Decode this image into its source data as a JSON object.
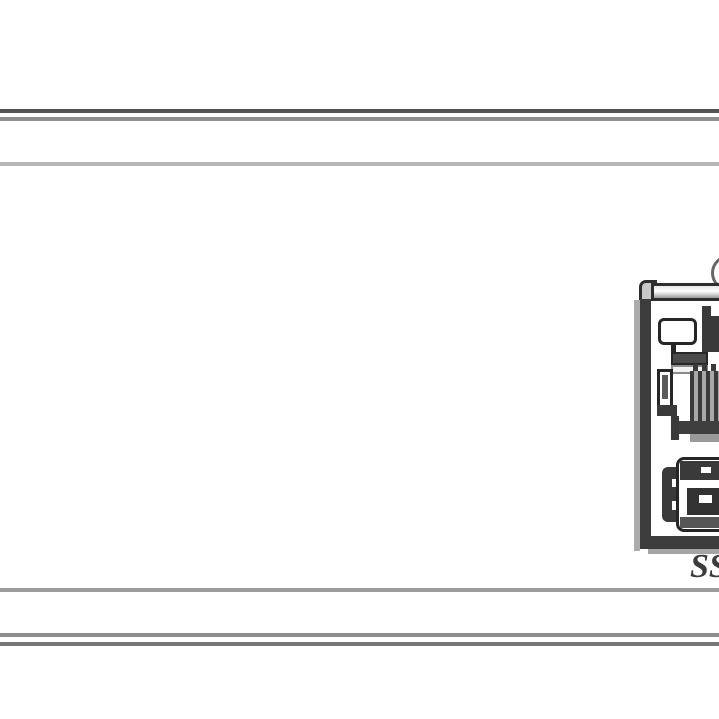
{
  "diagram": {
    "callout_label": "SS",
    "colors": {
      "edge_dark": "#535353",
      "edge_mid": "#8e8e8e",
      "edge_light": "#b6b6b6",
      "outline": "#262626",
      "frame_dark": "#3c3c3c",
      "metal_gray": "#a8a8a8",
      "background": "#ffffff"
    }
  }
}
